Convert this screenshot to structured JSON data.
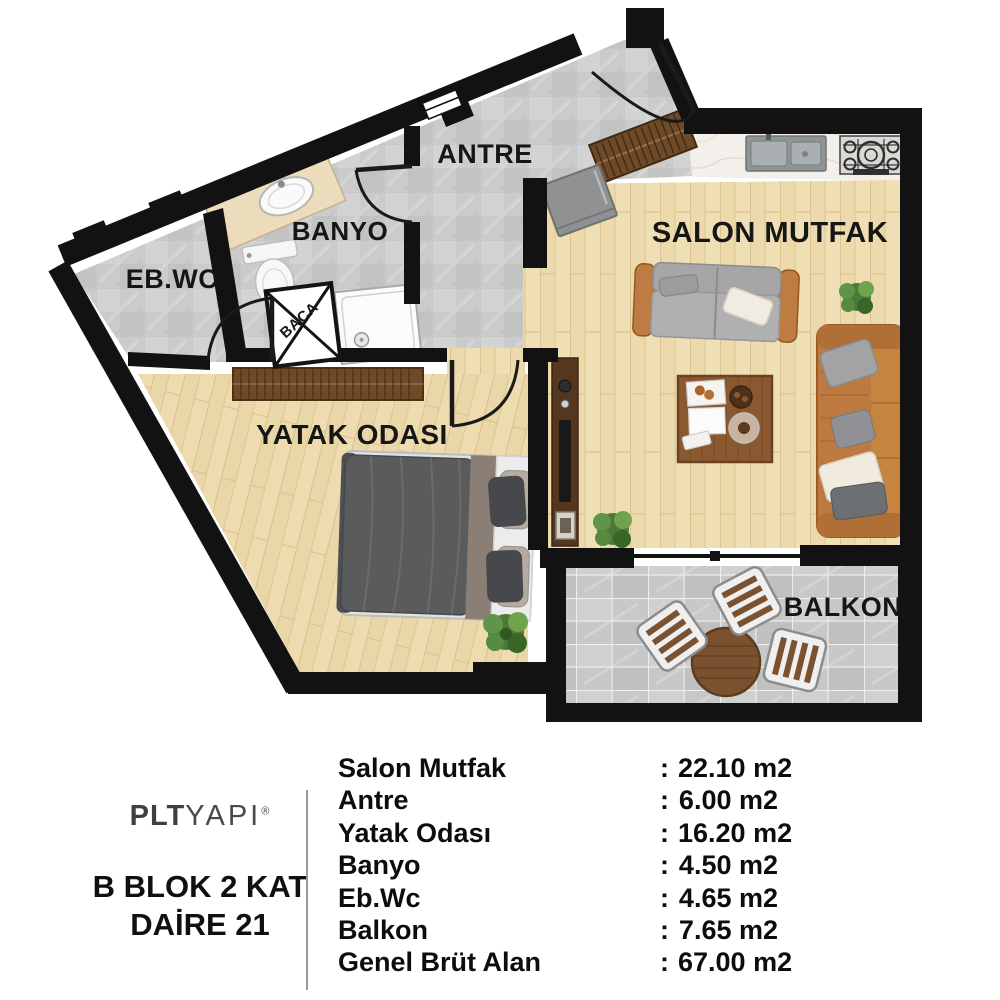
{
  "plan": {
    "room_labels": {
      "salon_mutfak": "SALON MUTFAK",
      "antre": "ANTRE",
      "banyo": "BANYO",
      "eb_wc": "EB.WC",
      "yatak_odasi": "YATAK ODASI",
      "balkon": "BALKON",
      "baca": "BACA"
    }
  },
  "legend": {
    "brand": {
      "bold": "PLT",
      "light": "YAPI",
      "registered": "®"
    },
    "unit": {
      "line1": "B BLOK 2 KAT",
      "line2": "DAİRE 21"
    },
    "rows": [
      {
        "label": "Salon Mutfak",
        "colon": ":",
        "value": "22.10 m2"
      },
      {
        "label": "Antre",
        "colon": ":",
        "value": "6.00 m2"
      },
      {
        "label": "Yatak Odası",
        "colon": ":",
        "value": "16.20 m2"
      },
      {
        "label": "Banyo",
        "colon": ":",
        "value": "4.50 m2"
      },
      {
        "label": "Eb.Wc",
        "colon": ":",
        "value": "4.65 m2"
      },
      {
        "label": "Balkon",
        "colon": ":",
        "value": "7.65 m2"
      },
      {
        "label": "Genel Brüt Alan",
        "colon": ":",
        "value": "67.00 m2"
      }
    ]
  },
  "colors": {
    "wall": "#121212",
    "wood_floor": "#efdfb4",
    "tile_floor": "#cbcbcb",
    "marble_counter": "#f3f0eb",
    "leather_sofa": "#bd7a40",
    "gray_sofa": "#a9a9ac",
    "plant_green": "#4c7a36"
  }
}
